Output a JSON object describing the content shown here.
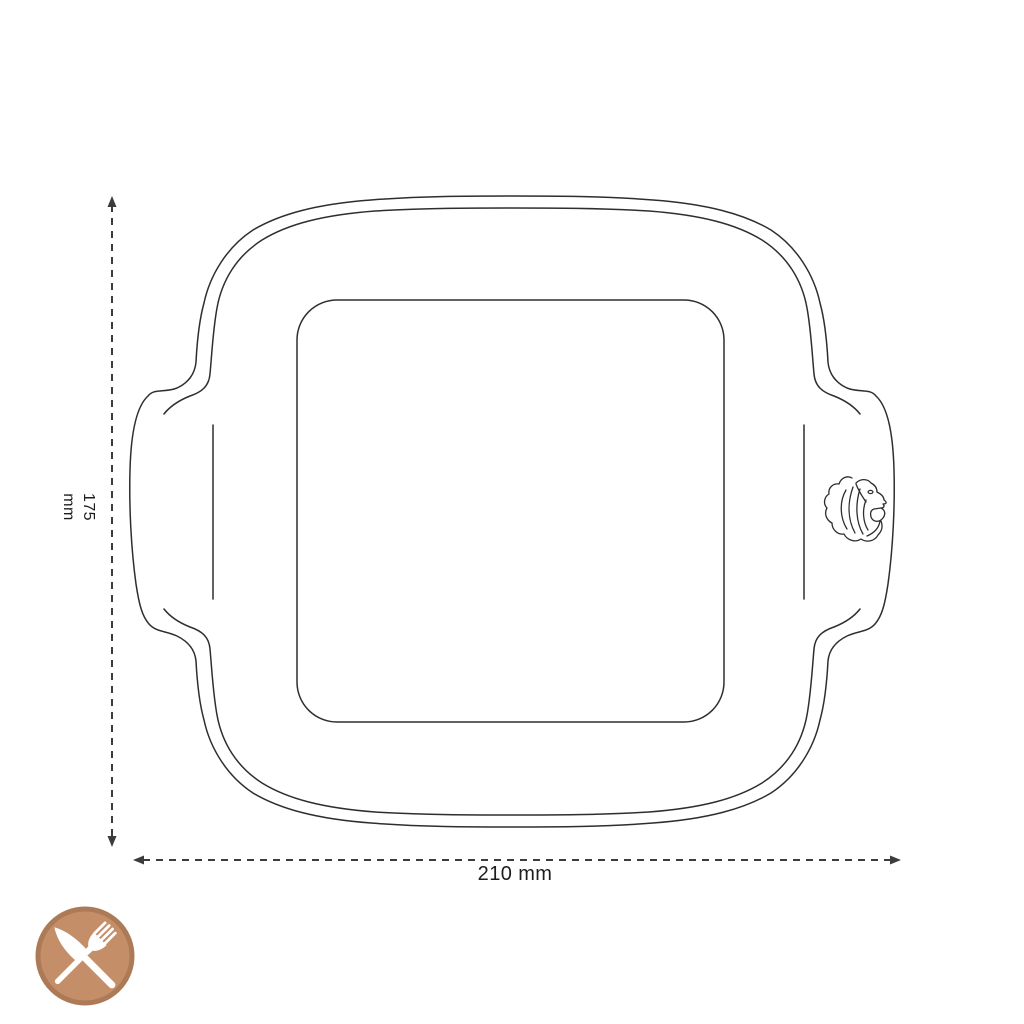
{
  "diagram": {
    "type": "product dimension drawing",
    "subject": "square oven dish with side handles, top view",
    "width_dim": {
      "label": "210 mm",
      "value": 210,
      "unit": "mm"
    },
    "height_dim": {
      "label": "175 mm",
      "value": 175,
      "unit": "mm"
    }
  },
  "icons": {
    "lion_logo": "lion-head-brand-mark",
    "badge": "crossed-knife-and-fork-category-badge"
  },
  "colors": {
    "background": "#ffffff",
    "line": "#2e2e2e",
    "dimension": "#3c3c3c",
    "badge_fill": "#c48e68",
    "badge_ring": "#ac7a56",
    "cutlery": "#ffffff"
  }
}
